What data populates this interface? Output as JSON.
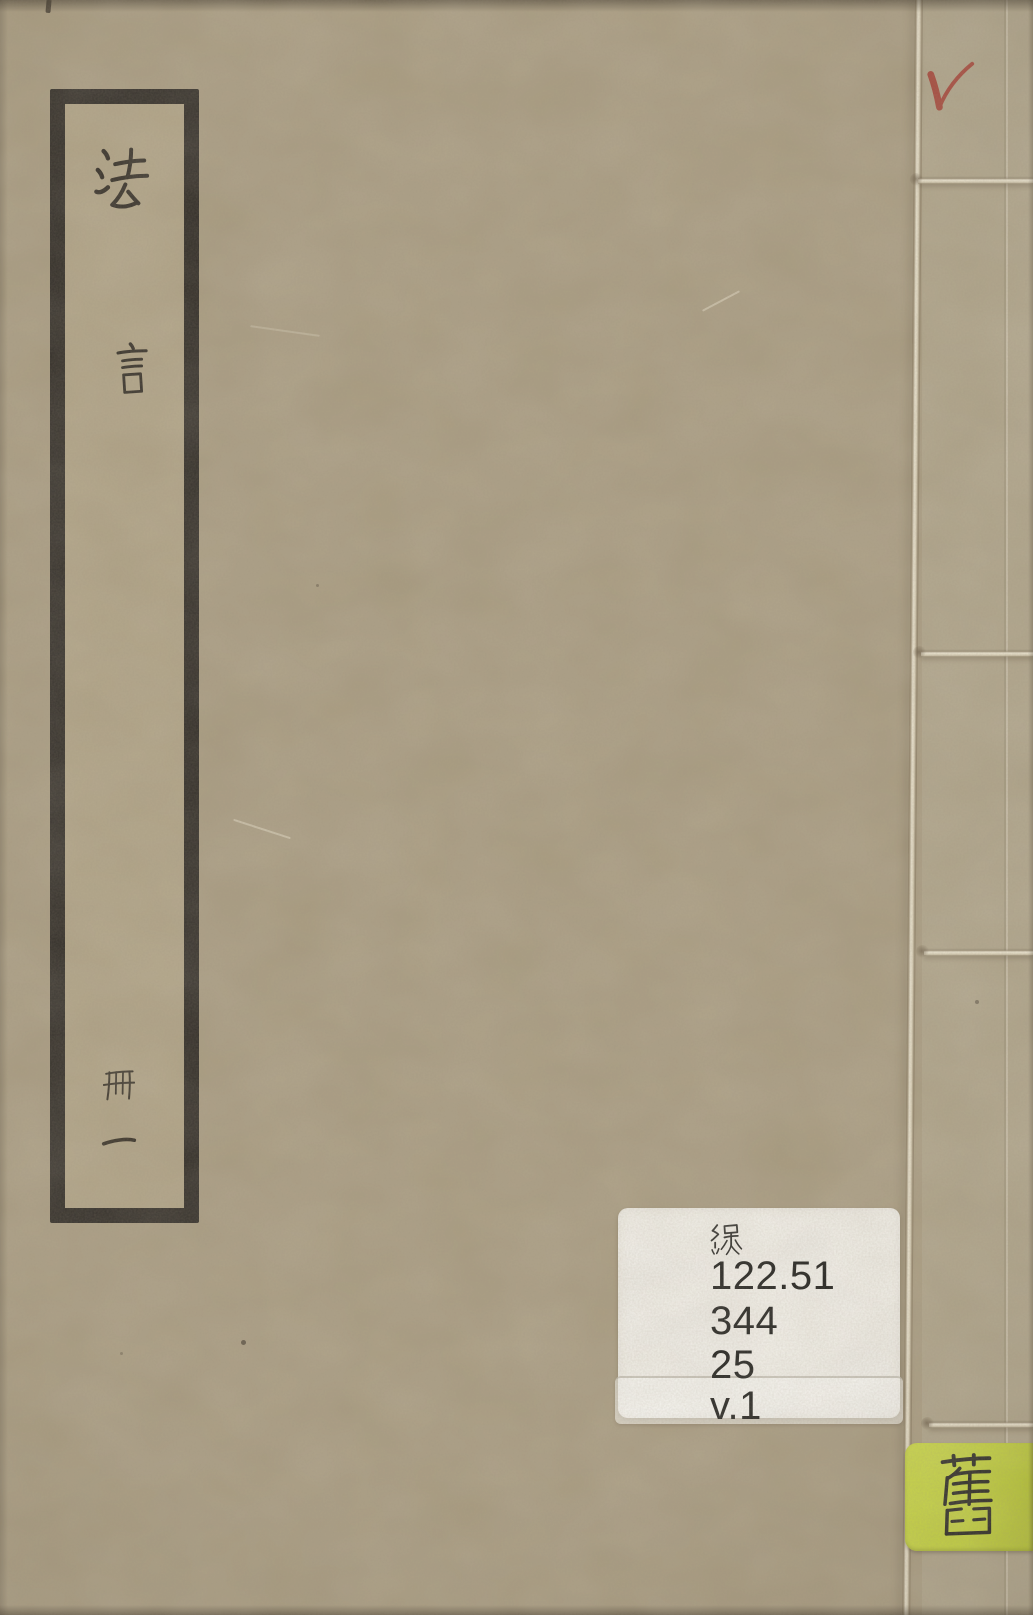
{
  "page": {
    "description": "Scanned cover of a thread-bound Chinese book, volume 1"
  },
  "title_label": {
    "title": "法言",
    "char1": "法",
    "char2": "言",
    "volume": "冊一",
    "volume_char1": "冊",
    "volume_char2": "一"
  },
  "call_sticker": {
    "category_char": "線",
    "lines": [
      "122.51",
      "344",
      "25",
      "v.1"
    ]
  },
  "old_tag": {
    "char": "舊"
  },
  "marks": {
    "checkmark_symbol": "✓"
  },
  "colors": {
    "cover": "#a89b80",
    "label_frame": "#2b2722",
    "ink": "#2e2922",
    "sticker_bg": "#f3f1eb",
    "sticker_text": "#1d1d1b",
    "old_tag_bg": "#c3d338",
    "old_tag_text": "#23221d",
    "checkmark_red": "#a33a2f",
    "thread": "#e9e2ce"
  }
}
